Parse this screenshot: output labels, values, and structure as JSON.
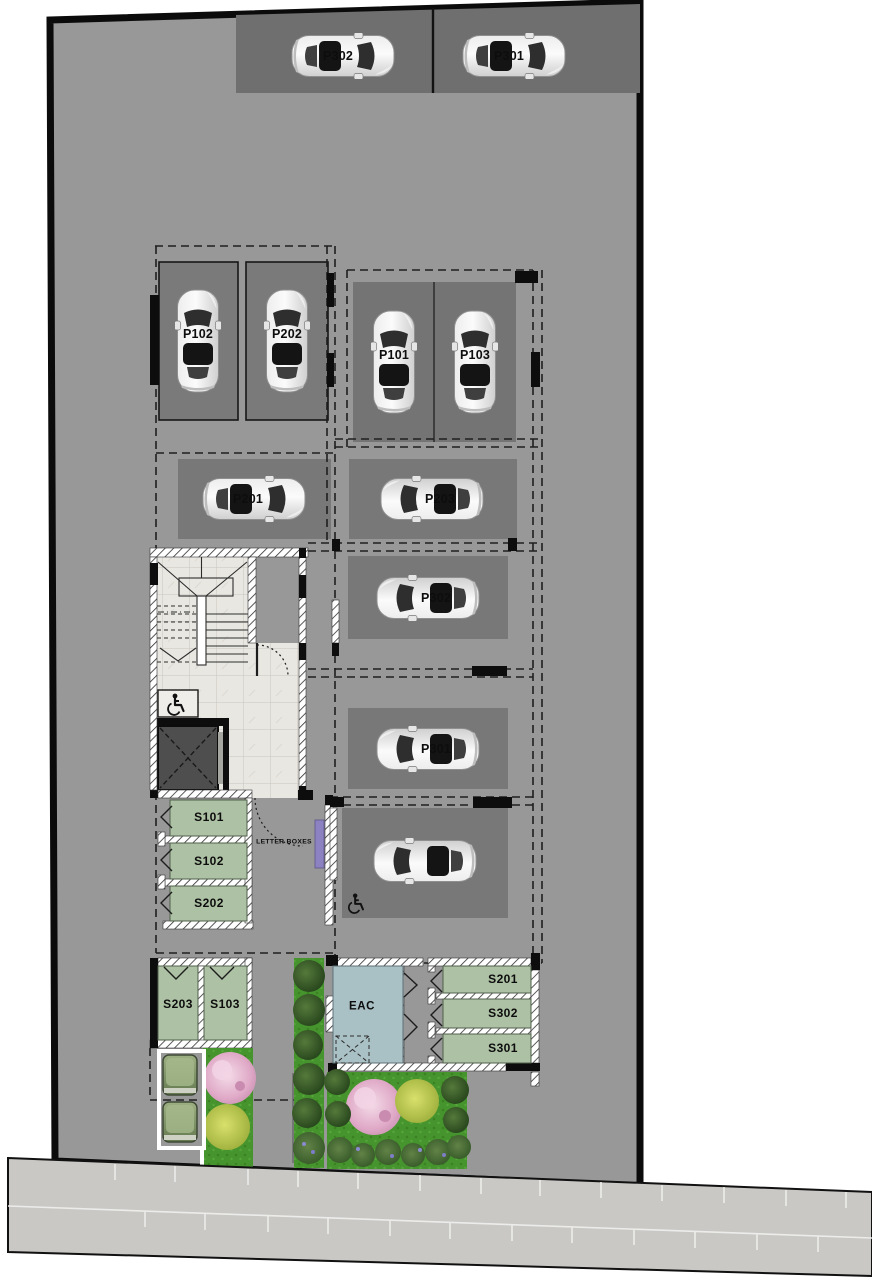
{
  "document": {
    "type": "parking-level site plan",
    "view": "top-down architectural drawing"
  },
  "spots": [
    {
      "id": "street-1",
      "label": "P302"
    },
    {
      "id": "street-2",
      "label": "P301"
    },
    {
      "id": "garage-1",
      "label": "P102"
    },
    {
      "id": "garage-2",
      "label": "P202"
    },
    {
      "id": "row-1",
      "label": "P101"
    },
    {
      "id": "row-2",
      "label": "P103"
    },
    {
      "id": "mid-1",
      "label": "P201"
    },
    {
      "id": "mid-2",
      "label": "P203"
    },
    {
      "id": "mid-3",
      "label": "P302"
    },
    {
      "id": "mid-4",
      "label": "P301"
    },
    {
      "id": "accessible",
      "label": ""
    }
  ],
  "rooms": [
    {
      "id": "s101",
      "label": "S101"
    },
    {
      "id": "s102",
      "label": "S102"
    },
    {
      "id": "s202",
      "label": "S202"
    },
    {
      "id": "s203",
      "label": "S203"
    },
    {
      "id": "s103",
      "label": "S103"
    },
    {
      "id": "eac",
      "label": "EAC"
    },
    {
      "id": "s201",
      "label": "S201"
    },
    {
      "id": "s302",
      "label": "S302"
    },
    {
      "id": "s301",
      "label": "S301"
    }
  ],
  "signs": {
    "letter_boxes": "LETTER BOXES"
  },
  "icons": {
    "accessible_parking": "wheelchair-icon",
    "stair_platform_lift": "wheelchair-icon"
  },
  "colors": {
    "site_gray": "#989898",
    "street_parking_strip": "#6f6f6f",
    "stall_gray": "#787878",
    "storage_green": "#adc1a4",
    "eac_blue": "#a9c0c4",
    "letterbox_purple": "#8d82c1",
    "elevator_cab": "#4e4e4e",
    "grass_green": "#46942d",
    "tree_pink": "#dfa8c6",
    "bush_yellow": "#b4c24c",
    "sidewalk_gray": "#c9c8c5",
    "boundary_black": "#0b0b0b"
  }
}
